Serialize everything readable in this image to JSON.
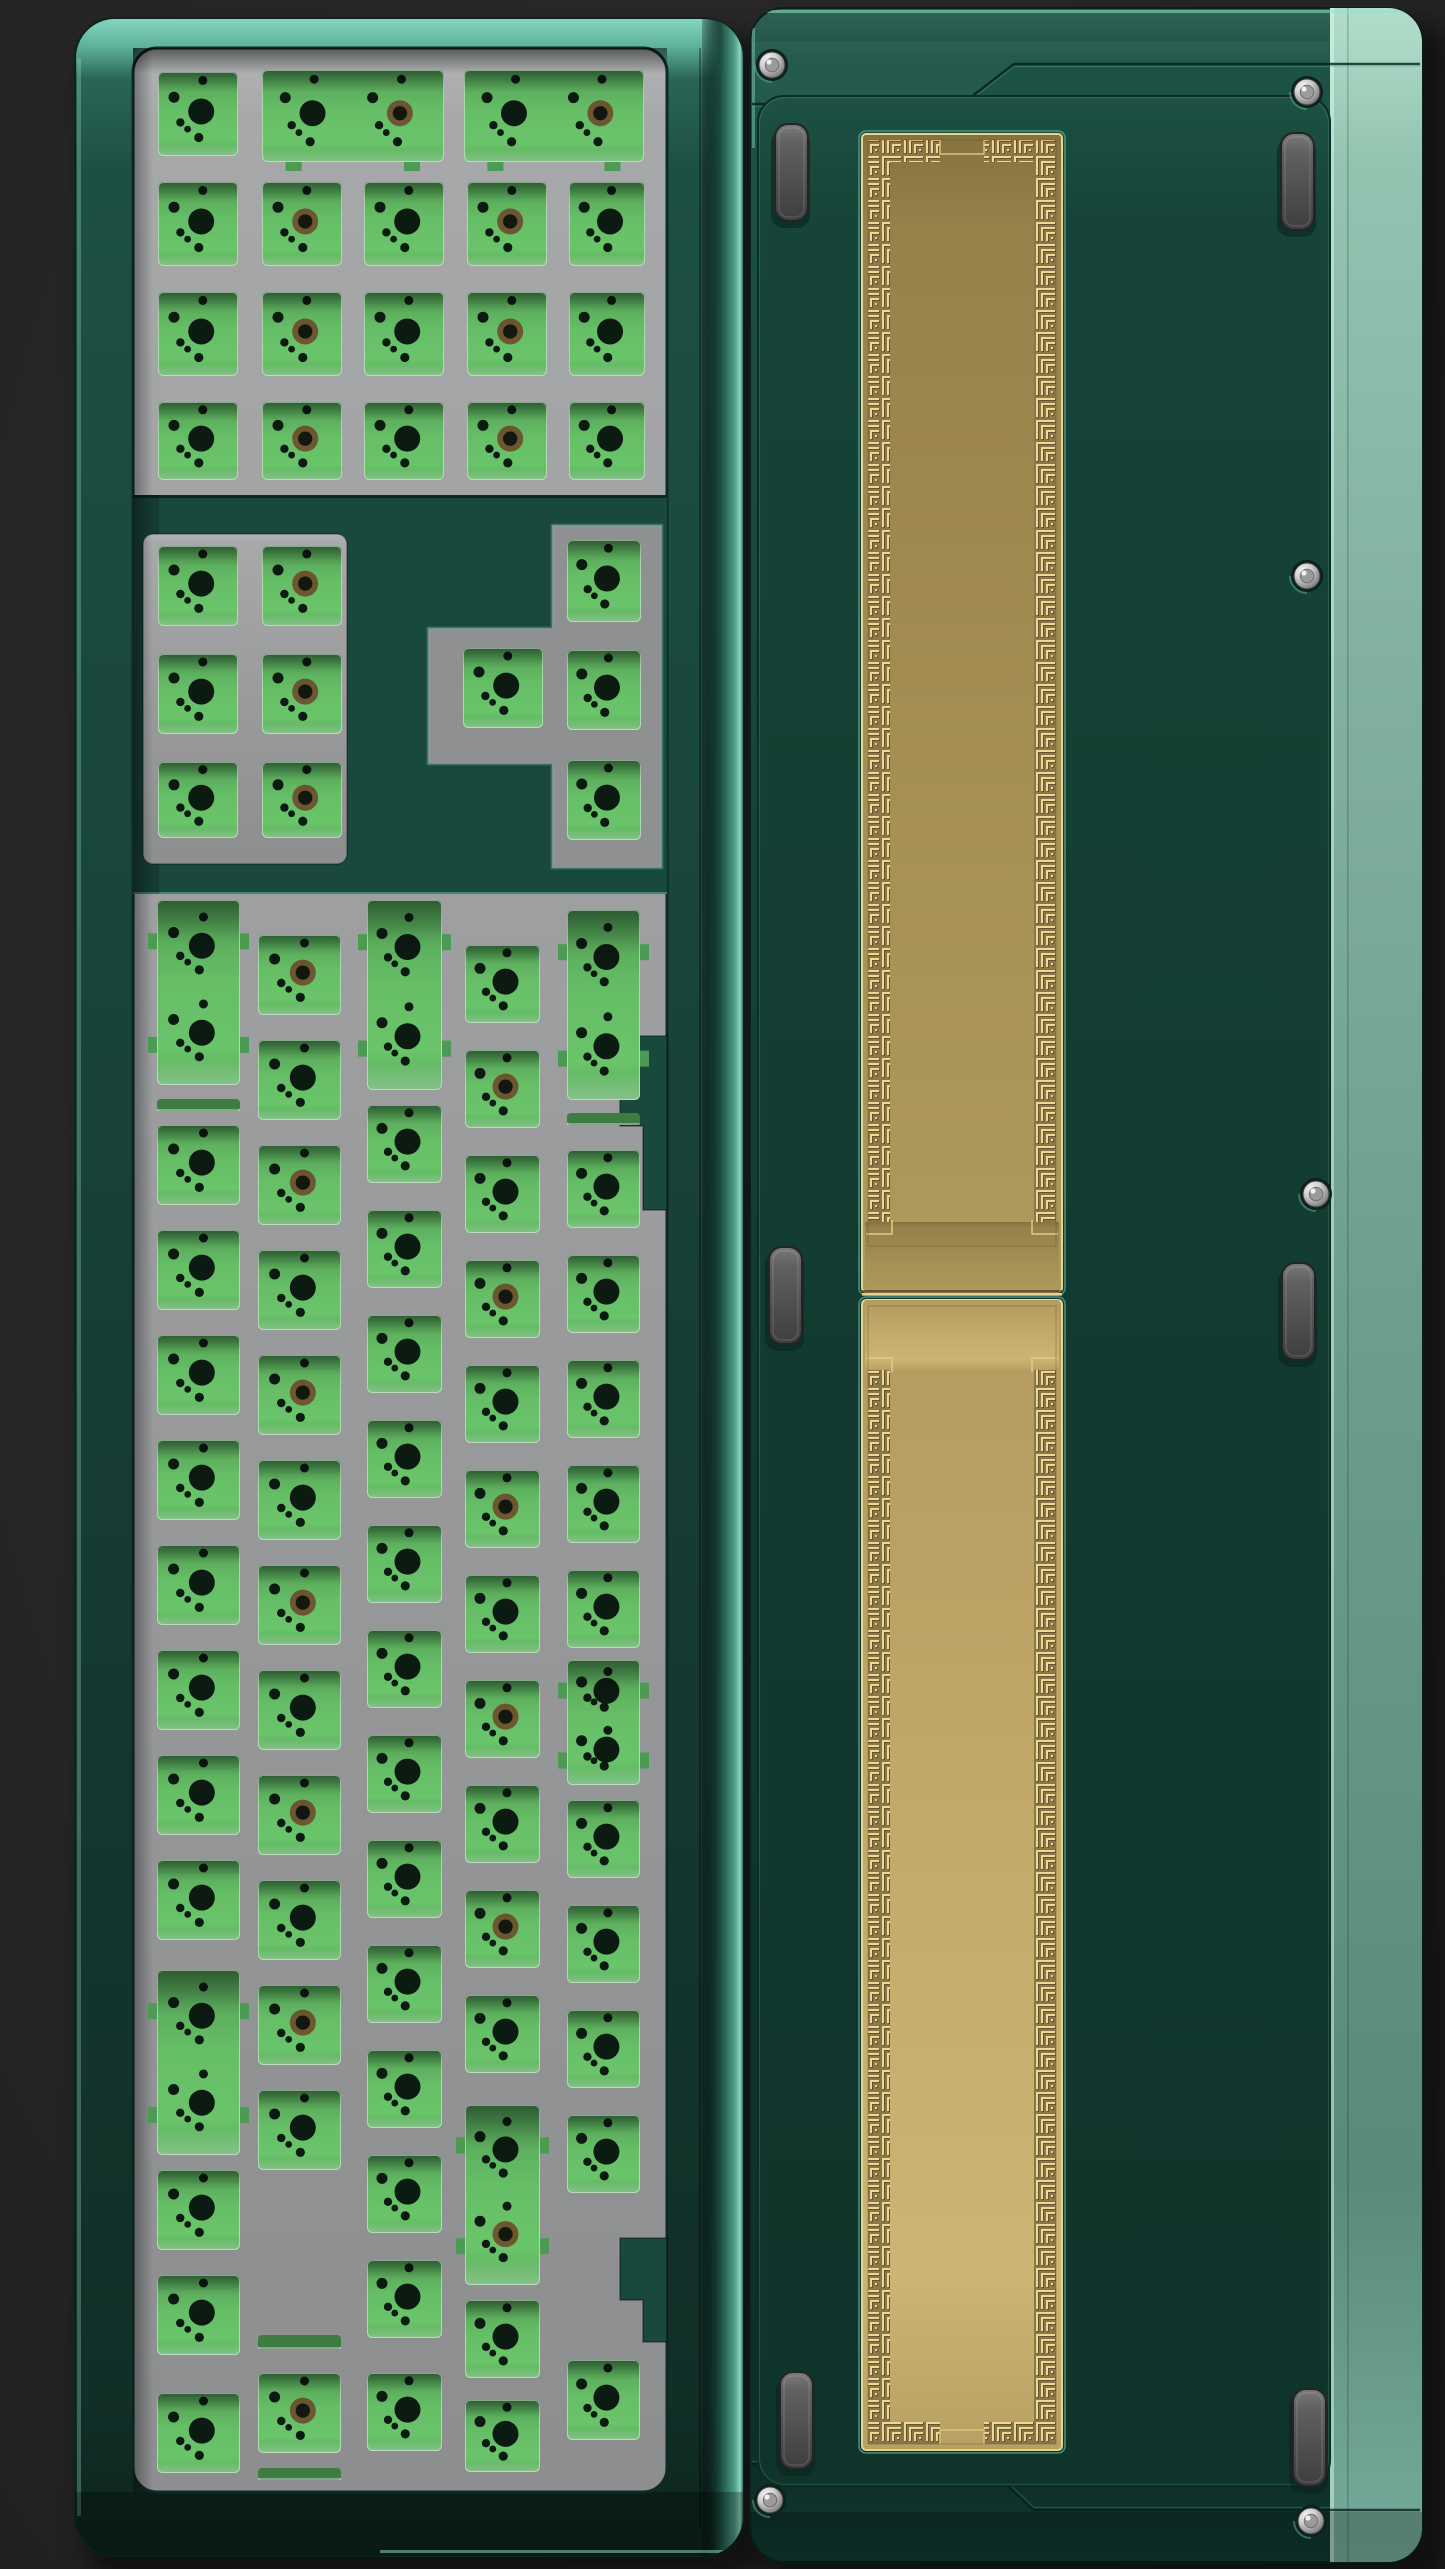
{
  "meta": {
    "canvas": {
      "w": 1445,
      "h": 2569
    }
  },
  "palette": {
    "bg_center": "#2e2e2e",
    "bg_edge": "#1e1e1e",
    "shadow": "#000000",
    "case_teal_mid": "#173f36",
    "case_teal_dark": "#0d241e",
    "case_mint_top": "#86d6c2",
    "mint_glint": "#8fd6c2",
    "mint_soft": "rgba(140,215,195,0.4)",
    "divider_teal": "#19493d",
    "plate_light": "#b2b3b5",
    "plate_mid": "#9a9b9d",
    "plate_dark": "#8d8e90",
    "plate_floor": "#8f9092",
    "pcb_green": "#66bd67",
    "pcb_green_dark": "#4c9a54",
    "pcb_slit": "#55a65b",
    "hole_black": "#0c1b12",
    "hole_brass": "#6d5730",
    "hole_brass_core": "#141710",
    "back_green_top": "#1c5144",
    "back_green": "#123a30",
    "back_green_deep": "#0f342b",
    "side_mint_top": "#b2ddcb",
    "side_mint": "#82b1a0",
    "side_mint_low": "#5a8b7a",
    "gold_band_bg": "#8a7647",
    "gold_line": "#ecd892",
    "gold_line_shadow": "#5f4f2c",
    "gold_frame": "#e9d48e",
    "gold_top_0": "#857240",
    "gold_top_1": "#a69055",
    "gold_bot_0": "#b39a5f",
    "gold_bot_1": "#ccb573",
    "foot_light": "#7b7b7b",
    "foot_dark": "#3e3e3e",
    "foot_edge": "#242424",
    "screw_metal": "#d2d2d2",
    "screw_dark": "#5a5a5a",
    "screw_glint": "#f5f5f5",
    "screw_recess": "#0c211c",
    "seam_dark": "rgba(6,33,27,0.8)"
  },
  "left_keyboard": {
    "case": {
      "x": 75,
      "y": 18,
      "w": 668,
      "h": 2538,
      "r": 40
    },
    "well": {
      "x": 133,
      "y": 48,
      "w": 534,
      "h": 2444,
      "r": 24
    },
    "teal_zone": {
      "y": 495,
      "h": 399
    },
    "sec2_block": {
      "x": 143,
      "y": 534,
      "w": 204,
      "h": 330,
      "r": 10
    },
    "t_cutout": {
      "vert": {
        "x": 552,
        "y": 525,
        "w": 110,
        "h": 343
      },
      "stub": {
        "x": 428,
        "y": 628,
        "w": 124,
        "h": 136
      },
      "outline": [
        [
          552,
          525
        ],
        [
          662,
          525
        ],
        [
          662,
          868
        ],
        [
          552,
          868
        ],
        [
          552,
          764
        ],
        [
          428,
          764
        ],
        [
          428,
          628
        ],
        [
          552,
          628
        ]
      ]
    },
    "notches": [
      [
        [
          667,
          1036
        ],
        [
          620,
          1036
        ],
        [
          620,
          1126
        ],
        [
          643,
          1126
        ],
        [
          643,
          1210
        ],
        [
          667,
          1210
        ]
      ],
      [
        [
          667,
          2238
        ],
        [
          620,
          2238
        ],
        [
          620,
          2300
        ],
        [
          643,
          2300
        ],
        [
          643,
          2342
        ],
        [
          667,
          2342
        ]
      ]
    ],
    "hole_map": [
      [
        0.56,
        0.1,
        4.5
      ],
      [
        0.2,
        0.3,
        5.5
      ],
      [
        0.54,
        0.47,
        13
      ],
      [
        0.28,
        0.6,
        4.2
      ],
      [
        0.37,
        0.68,
        3.4
      ],
      [
        0.51,
        0.78,
        4.6
      ]
    ],
    "cutouts": [
      [
        158,
        72,
        80,
        84,
        "k",
        0
      ],
      [
        262,
        70,
        182,
        92,
        "w",
        1
      ],
      [
        464,
        70,
        180,
        92,
        "w",
        1
      ],
      [
        158,
        182,
        80,
        84,
        "k",
        0
      ],
      [
        262,
        182,
        80,
        84,
        "k",
        1
      ],
      [
        364,
        182,
        80,
        84,
        "k",
        0
      ],
      [
        467,
        182,
        80,
        84,
        "k",
        1
      ],
      [
        569,
        182,
        76,
        84,
        "k",
        0
      ],
      [
        158,
        292,
        80,
        84,
        "k",
        0
      ],
      [
        262,
        292,
        80,
        84,
        "k",
        1
      ],
      [
        364,
        292,
        80,
        84,
        "k",
        0
      ],
      [
        467,
        292,
        80,
        84,
        "k",
        1
      ],
      [
        569,
        292,
        76,
        84,
        "k",
        0
      ],
      [
        158,
        402,
        80,
        78,
        "k",
        0
      ],
      [
        262,
        402,
        80,
        78,
        "k",
        1
      ],
      [
        364,
        402,
        80,
        78,
        "k",
        0
      ],
      [
        467,
        402,
        80,
        78,
        "k",
        1
      ],
      [
        569,
        402,
        76,
        78,
        "k",
        0
      ],
      [
        158,
        546,
        80,
        80,
        "k",
        0
      ],
      [
        262,
        546,
        80,
        80,
        "k",
        1
      ],
      [
        158,
        654,
        80,
        80,
        "k",
        0
      ],
      [
        262,
        654,
        80,
        80,
        "k",
        1
      ],
      [
        158,
        762,
        80,
        76,
        "k",
        0
      ],
      [
        262,
        762,
        80,
        76,
        "k",
        1
      ],
      [
        567,
        540,
        74,
        82,
        "k",
        0
      ],
      [
        567,
        650,
        74,
        80,
        "k",
        0
      ],
      [
        567,
        760,
        74,
        80,
        "k",
        0
      ],
      [
        463,
        648,
        80,
        80,
        "k",
        0
      ],
      [
        157,
        900,
        83,
        185,
        "t",
        0
      ],
      [
        157,
        1099,
        83,
        12,
        "s",
        0
      ],
      [
        157,
        1125,
        83,
        80,
        "k",
        0
      ],
      [
        157,
        1230,
        83,
        80,
        "k",
        0
      ],
      [
        157,
        1335,
        83,
        80,
        "k",
        0
      ],
      [
        157,
        1440,
        83,
        80,
        "k",
        0
      ],
      [
        157,
        1545,
        83,
        80,
        "k",
        0
      ],
      [
        157,
        1650,
        83,
        80,
        "k",
        0
      ],
      [
        157,
        1755,
        83,
        80,
        "k",
        0
      ],
      [
        157,
        1860,
        83,
        80,
        "k",
        0
      ],
      [
        157,
        1970,
        83,
        185,
        "t",
        0
      ],
      [
        157,
        2170,
        83,
        80,
        "k",
        0
      ],
      [
        157,
        2275,
        83,
        80,
        "k",
        0
      ],
      [
        157,
        2393,
        83,
        80,
        "k",
        0
      ],
      [
        258,
        935,
        83,
        80,
        "k",
        1
      ],
      [
        258,
        1040,
        83,
        80,
        "k",
        0
      ],
      [
        258,
        1145,
        83,
        80,
        "k",
        1
      ],
      [
        258,
        1250,
        83,
        80,
        "k",
        0
      ],
      [
        258,
        1355,
        83,
        80,
        "k",
        1
      ],
      [
        258,
        1460,
        83,
        80,
        "k",
        0
      ],
      [
        258,
        1565,
        83,
        80,
        "k",
        1
      ],
      [
        258,
        1670,
        83,
        80,
        "k",
        0
      ],
      [
        258,
        1775,
        83,
        80,
        "k",
        1
      ],
      [
        258,
        1880,
        83,
        80,
        "k",
        0
      ],
      [
        258,
        1985,
        83,
        80,
        "k",
        1
      ],
      [
        258,
        2090,
        83,
        80,
        "k",
        0
      ],
      [
        258,
        2335,
        83,
        14,
        "s",
        0
      ],
      [
        258,
        2373,
        83,
        80,
        "k",
        1
      ],
      [
        258,
        2468,
        83,
        12,
        "s",
        0
      ],
      [
        367,
        900,
        75,
        190,
        "t",
        0
      ],
      [
        367,
        1105,
        75,
        78,
        "k",
        0
      ],
      [
        367,
        1210,
        75,
        78,
        "k",
        0
      ],
      [
        367,
        1315,
        75,
        78,
        "k",
        0
      ],
      [
        367,
        1420,
        75,
        78,
        "k",
        0
      ],
      [
        367,
        1525,
        75,
        78,
        "k",
        0
      ],
      [
        367,
        1630,
        75,
        78,
        "k",
        0
      ],
      [
        367,
        1735,
        75,
        78,
        "k",
        0
      ],
      [
        367,
        1840,
        75,
        78,
        "k",
        0
      ],
      [
        367,
        1945,
        75,
        78,
        "k",
        0
      ],
      [
        367,
        2050,
        75,
        78,
        "k",
        0
      ],
      [
        367,
        2155,
        75,
        78,
        "k",
        0
      ],
      [
        367,
        2260,
        75,
        78,
        "k",
        0
      ],
      [
        367,
        2373,
        75,
        78,
        "k",
        0
      ],
      [
        465,
        945,
        75,
        78,
        "k",
        0
      ],
      [
        465,
        1050,
        75,
        78,
        "k",
        1
      ],
      [
        465,
        1155,
        75,
        78,
        "k",
        0
      ],
      [
        465,
        1260,
        75,
        78,
        "k",
        1
      ],
      [
        465,
        1365,
        75,
        78,
        "k",
        0
      ],
      [
        465,
        1470,
        75,
        78,
        "k",
        1
      ],
      [
        465,
        1575,
        75,
        78,
        "k",
        0
      ],
      [
        465,
        1680,
        75,
        78,
        "k",
        1
      ],
      [
        465,
        1785,
        75,
        78,
        "k",
        0
      ],
      [
        465,
        1890,
        75,
        78,
        "k",
        1
      ],
      [
        465,
        1995,
        75,
        78,
        "k",
        0
      ],
      [
        465,
        2105,
        75,
        180,
        "t",
        1
      ],
      [
        465,
        2300,
        75,
        78,
        "k",
        0
      ],
      [
        465,
        2400,
        75,
        72,
        "k",
        0
      ],
      [
        567,
        910,
        73,
        190,
        "t",
        0
      ],
      [
        567,
        1113,
        73,
        12,
        "s",
        0
      ],
      [
        567,
        1150,
        73,
        78,
        "k",
        0
      ],
      [
        567,
        1255,
        73,
        78,
        "k",
        0
      ],
      [
        567,
        1360,
        73,
        78,
        "k",
        0
      ],
      [
        567,
        1465,
        73,
        78,
        "k",
        0
      ],
      [
        567,
        1570,
        73,
        78,
        "k",
        0
      ],
      [
        567,
        1660,
        73,
        125,
        "t",
        0
      ],
      [
        567,
        1800,
        73,
        78,
        "k",
        0
      ],
      [
        567,
        1905,
        73,
        78,
        "k",
        0
      ],
      [
        567,
        2010,
        73,
        78,
        "k",
        0
      ],
      [
        567,
        2115,
        73,
        78,
        "k",
        0
      ],
      [
        567,
        2360,
        73,
        80,
        "k",
        0
      ]
    ]
  },
  "right_keyboard": {
    "case": {
      "x": 750,
      "y": 8,
      "w": 672,
      "h": 2554,
      "r": 34
    },
    "side_strip": {
      "x": 1330,
      "w": 92
    },
    "side_seam_x": 1347,
    "panel": {
      "x": 758,
      "y": 96,
      "w": 572,
      "h": 2390,
      "r": 26
    },
    "accent_top": [
      [
        752,
        104
      ],
      [
        962,
        104
      ],
      [
        1014,
        64
      ],
      [
        1420,
        64
      ]
    ],
    "accent_top_fill": [
      [
        752,
        42
      ],
      [
        1420,
        42
      ],
      [
        1420,
        64
      ],
      [
        1014,
        64
      ],
      [
        962,
        104
      ],
      [
        752,
        104
      ]
    ],
    "accent_bottom": [
      [
        752,
        2464
      ],
      [
        985,
        2464
      ],
      [
        1034,
        2510
      ],
      [
        1420,
        2510
      ]
    ],
    "gold": {
      "x": 862,
      "w": 200,
      "band": 22,
      "gap": 44,
      "top": {
        "y": 134,
        "h": 1158
      },
      "bottom": {
        "y": 1300,
        "h": 1150
      },
      "seam_y": 1292,
      "plain_zone": 70
    },
    "feet": [
      [
        775,
        124
      ],
      [
        1281,
        133
      ],
      [
        769,
        1247
      ],
      [
        1282,
        1263
      ],
      [
        780,
        2372
      ],
      [
        1293,
        2389
      ]
    ],
    "foot_size": {
      "w": 33,
      "h": 97,
      "r": 13
    },
    "screws": [
      [
        772,
        65
      ],
      [
        1307,
        92
      ],
      [
        1307,
        576
      ],
      [
        1316,
        1194
      ],
      [
        770,
        2500
      ],
      [
        1311,
        2521
      ]
    ],
    "screw_r": 13
  }
}
